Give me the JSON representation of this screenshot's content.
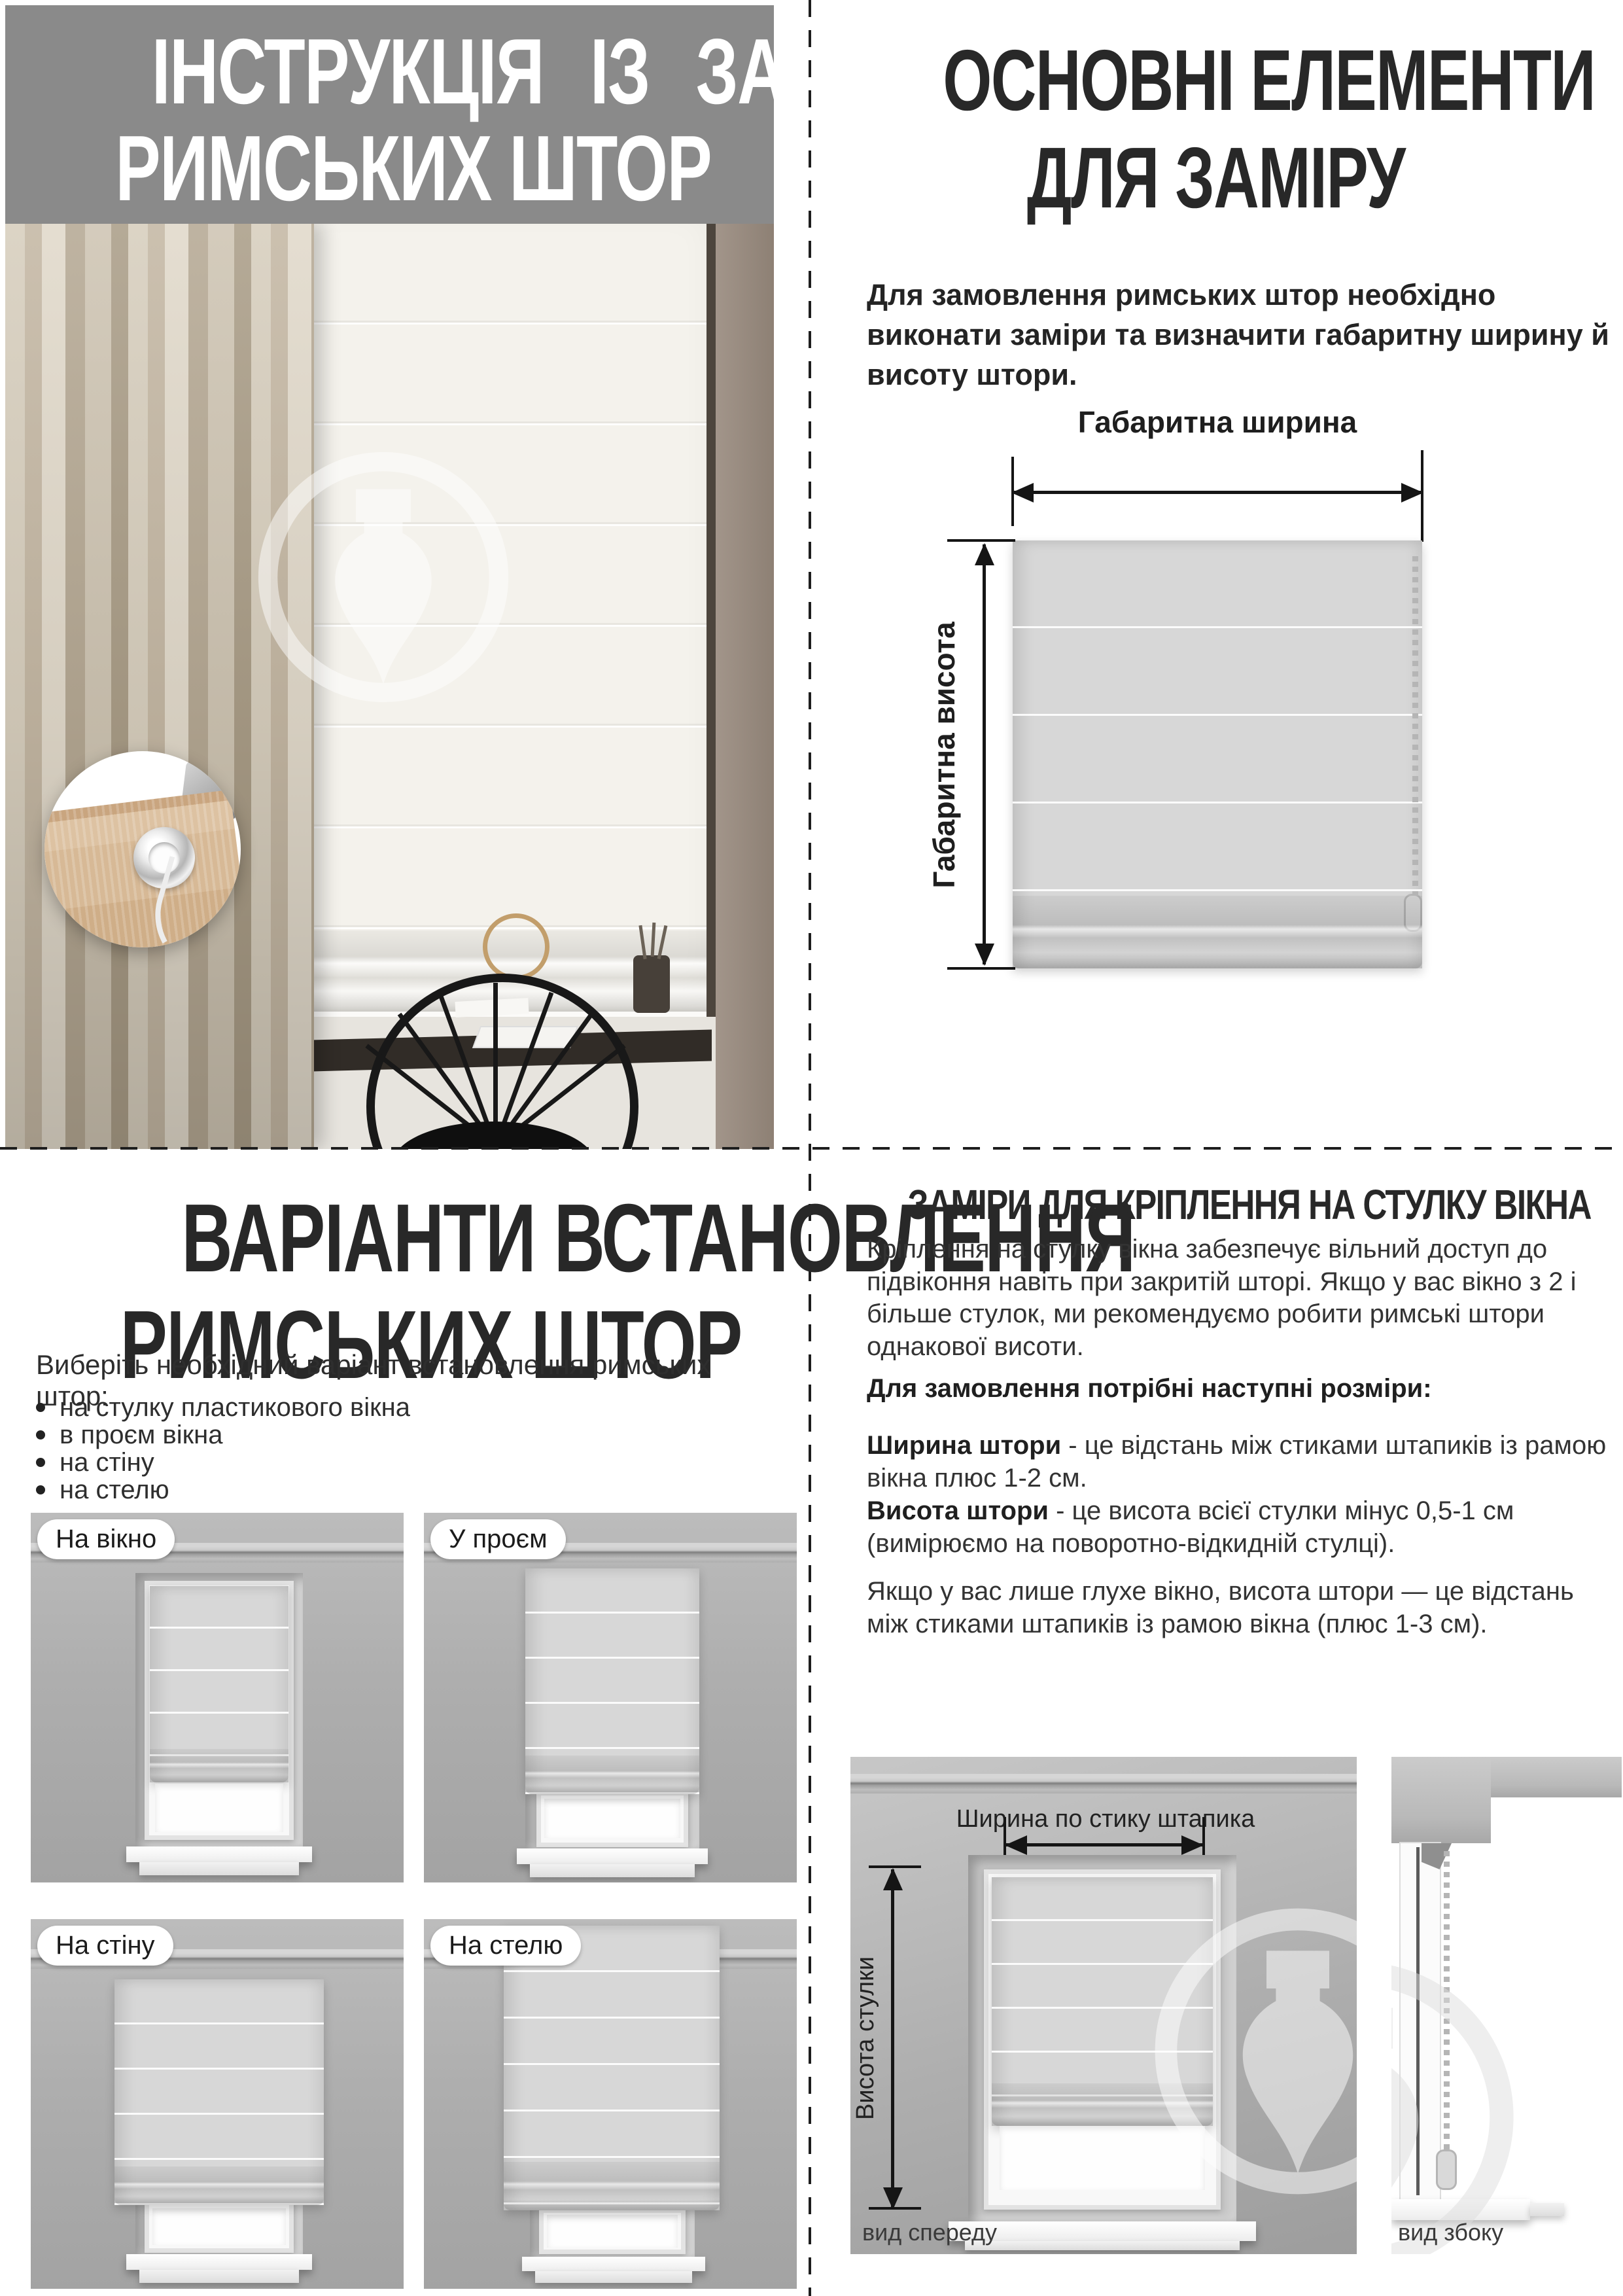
{
  "top_left": {
    "header_bg": "#8a8a8a",
    "title_line1": "ІНСТРУКЦІЯ ІЗ ЗАМІРУ",
    "title_line2": "РИМСЬКИХ ШТОР"
  },
  "top_right": {
    "heading_line1": "ОСНОВНІ ЕЛЕМЕНТИ",
    "heading_line2": "ДЛЯ ЗАМІРУ",
    "intro": "Для замовлення римських штор необхідно виконати заміри та визначити габаритну ширину й висоту штори.",
    "diagram": {
      "width_label": "Габаритна ширина",
      "height_label": "Габаритна висота"
    }
  },
  "bottom_left": {
    "heading_line1": "ВАРІАНТИ ВСТАНОВЛЕННЯ",
    "heading_line2": "РИМСЬКИХ ШТОР",
    "chooser": "Виберіть необхідний варіант встановлення римських штор:",
    "bullets": [
      "на стулку пластикового вікна",
      "в проєм вікна",
      "на стіну",
      "на стелю"
    ],
    "tiles": [
      {
        "label": "На вікно"
      },
      {
        "label": "У проєм"
      },
      {
        "label": "На стіну"
      },
      {
        "label": "На стелю"
      }
    ]
  },
  "bottom_right": {
    "heading": "ЗАМІРИ ДЛЯ КРІПЛЕННЯ НА СТУЛКУ ВІКНА",
    "para1": "Кріплення на стулку вікна забезпечує вільний доступ до підвіконня навіть при закритій шторі. Якщо у вас вікно з 2 і більше стулок, ми рекомендуємо робити римські штори однакової висоти.",
    "sizes_lead": "Для замовлення потрібні наступні розміри:",
    "width_term": "Ширина штори",
    "width_def": " - це відстань між стиками штапиків із рамою вікна плюс 1-2 см.",
    "height_term": "Висота штори",
    "height_def": " - це висота всієї стулки мінус 0,5-1 см (вимірюємо на поворотно-відкидній стулці).",
    "note": "Якщо у вас лише глухе вікно, висота штори — це відстань між стиками штапиків із рамою вікна (плюс 1-3 см).",
    "diagram": {
      "width_label": "Ширина по стику штапика",
      "height_label": "Висота стулки",
      "front_caption": "вид спереду",
      "side_caption": "вид збоку"
    }
  }
}
